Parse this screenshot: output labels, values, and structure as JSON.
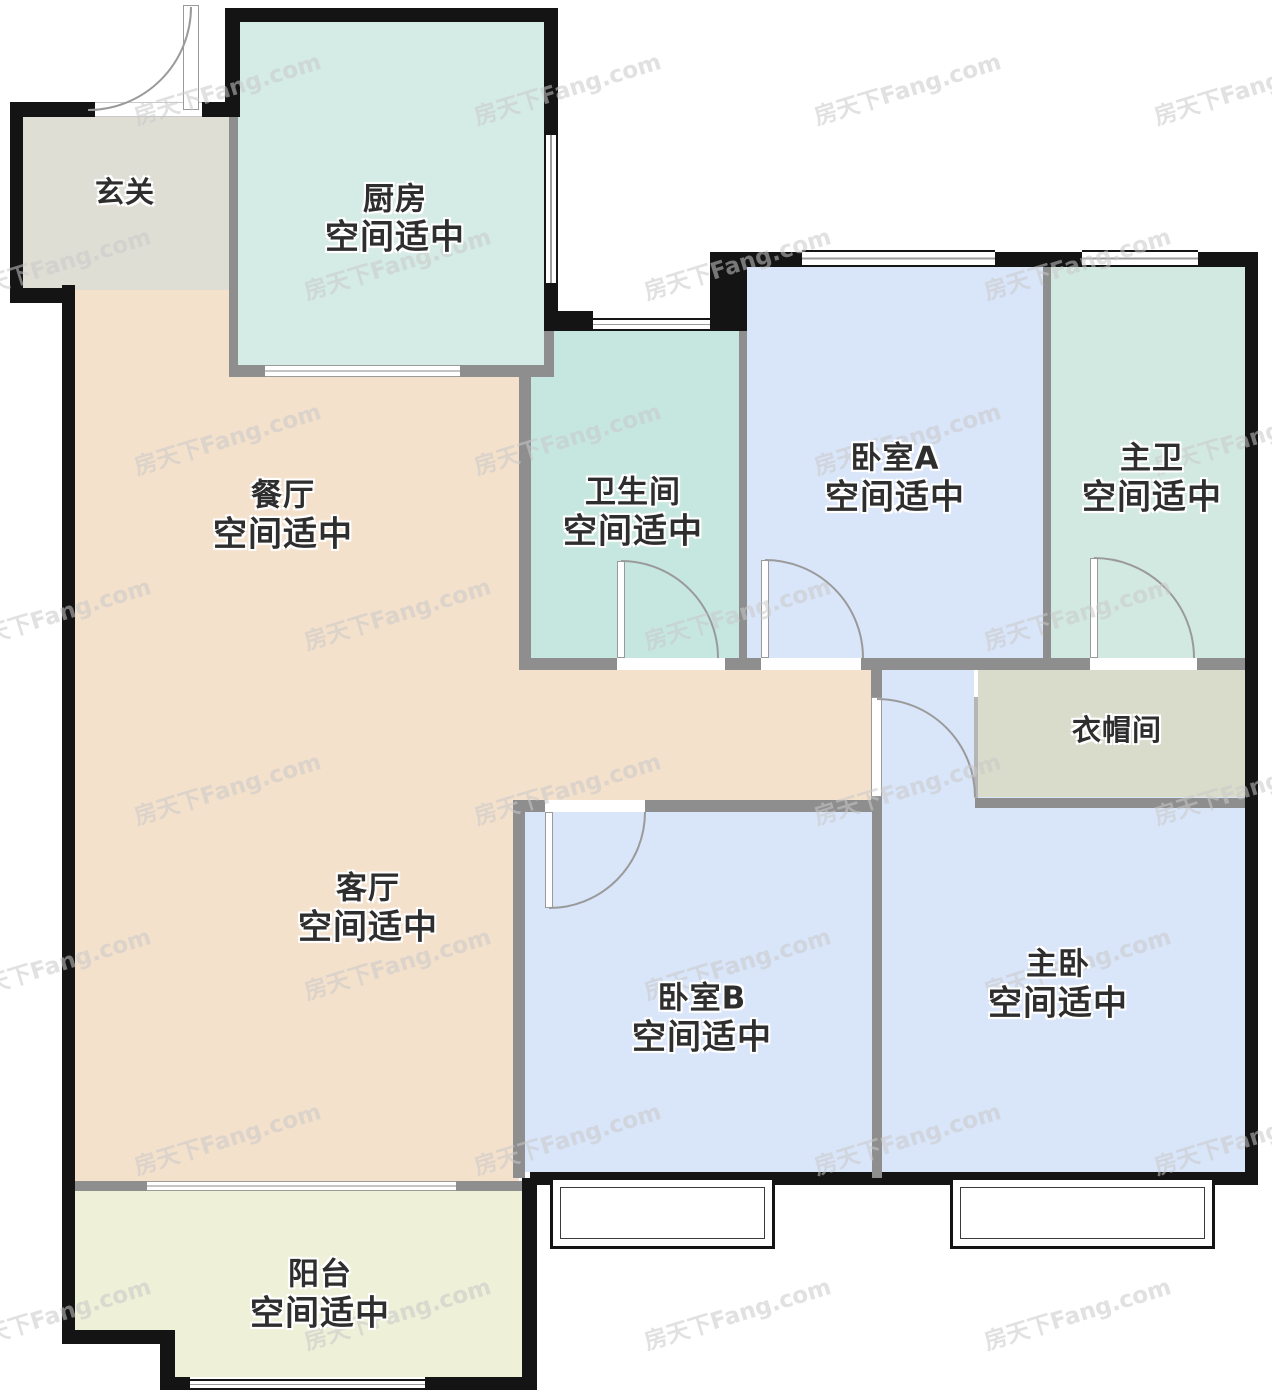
{
  "watermark": {
    "text": "房天下Fang.com"
  },
  "rooms": {
    "xuanguan": {
      "name": "玄关"
    },
    "chufang": {
      "name": "厨房",
      "status": "空间适中"
    },
    "canting": {
      "name": "餐厅",
      "status": "空间适中"
    },
    "weishengjian": {
      "name": "卫生间",
      "status": "空间适中"
    },
    "woshiA": {
      "name": "卧室A",
      "status": "空间适中"
    },
    "zhuwei": {
      "name": "主卫",
      "status": "空间适中"
    },
    "yimaojian": {
      "name": "衣帽间"
    },
    "keting": {
      "name": "客厅",
      "status": "空间适中"
    },
    "woshiB": {
      "name": "卧室B",
      "status": "空间适中"
    },
    "zhuwo": {
      "name": "主卧",
      "status": "空间适中"
    },
    "yangtai": {
      "name": "阳台",
      "status": "空间适中"
    }
  },
  "colors": {
    "wall_exterior": "#141414",
    "wall_interior": "#8e8e8e",
    "foyer": "#dfded5",
    "kitchen": "#d5ebe5",
    "dining_living": "#f4e1cc",
    "bathroom": "#c6e7df",
    "bedroom_a": "#d9e5f9",
    "master_bath": "#d2e9e1",
    "cloakroom": "#d9dbcb",
    "bedroom_b": "#d9e5f9",
    "master_bed": "#d9e5f9",
    "corridor": "#d9e5f9",
    "balcony": "#eef0d8",
    "watermark": "rgba(200,200,200,0.55)"
  }
}
